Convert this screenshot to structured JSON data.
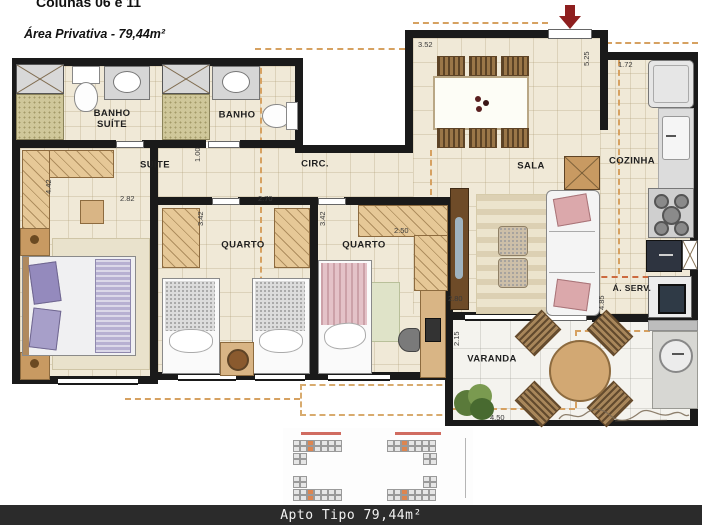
{
  "page": {
    "title_line": "Colunas 06 e 11",
    "area_line": "Área Privativa - 79,44m²",
    "footer_caption": "Apto Tipo 79,44m²"
  },
  "rooms": {
    "banho_suite": "BANHO\nSUÍTE",
    "banho": "BANHO",
    "suite": "SUÍTE",
    "circ": "CIRC.",
    "quarto_1": "QUARTO",
    "quarto_2": "QUARTO",
    "sala": "SALA",
    "cozinha": "COZINHA",
    "area_servico": "Á. SERV.",
    "varanda": "VARANDA"
  },
  "dimensions": {
    "dining_width": "3.52",
    "entry_depth": "5.25",
    "cozinha_width": "1.72",
    "circ_width": "1.00",
    "suite_depth": "4.42",
    "suite_width": "2.82",
    "quarto1_depth": "3.42",
    "quarto1_width": "2.70",
    "quarto2_depth": "3.42",
    "quarto2_width": "2.50",
    "sala_width": "2.80",
    "varanda_depth": "2.15",
    "cozinha_depth": "4.85",
    "varanda_width": "4.50"
  },
  "colors": {
    "wall": "#1a1a1a",
    "floor": "#f0e9d7",
    "varanda_floor": "#f4f3ee",
    "wardrobe": "#e6c897",
    "dashed_projection": "#d6a161",
    "entrance_arrow": "#8e1f1f",
    "footer_bg": "#2b2b2b",
    "site_plan_highlight": "#dd8550"
  },
  "site_plan": {
    "blocks": 4,
    "highlighted_units_per_block": 2
  }
}
